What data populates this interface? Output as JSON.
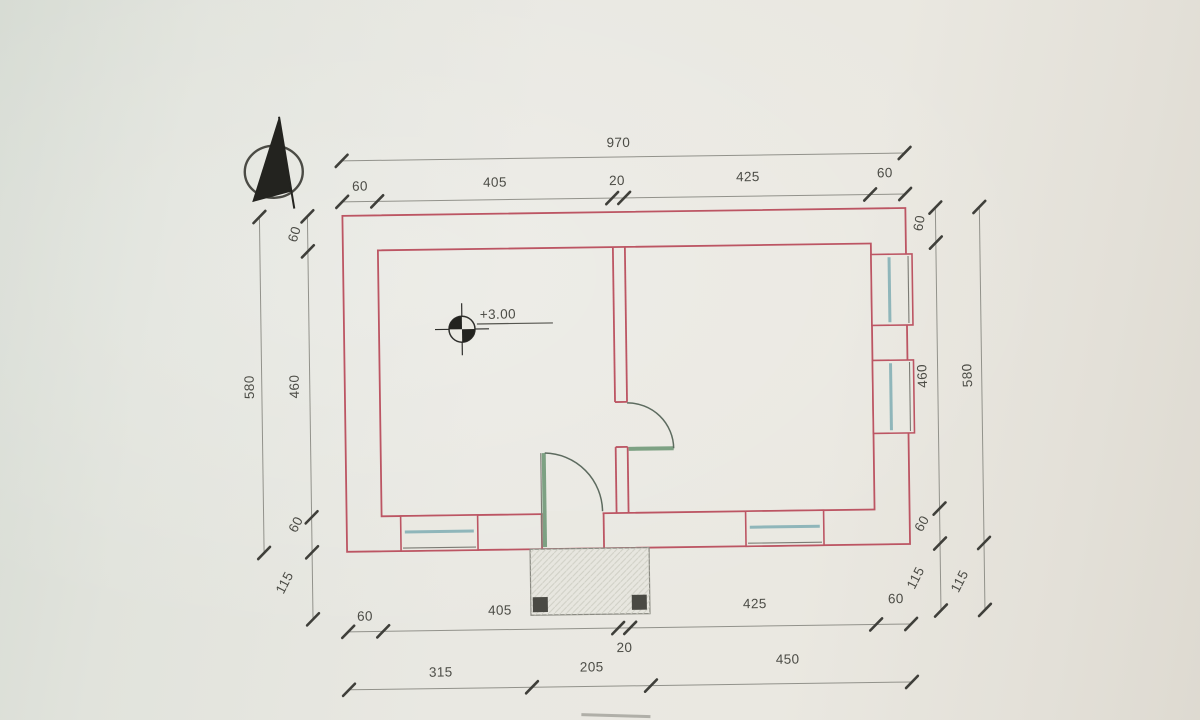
{
  "drawing": {
    "level_marker_text": "+3.00",
    "dimensions_top": {
      "overall": "970",
      "segments": [
        "60",
        "405",
        "20",
        "425",
        "60"
      ]
    },
    "dimensions_bottom": {
      "segments": [
        "60",
        "405",
        "20",
        "425",
        "60"
      ],
      "overall": [
        "315",
        "205",
        "450"
      ]
    },
    "dimensions_left": {
      "overall": "580",
      "segments": [
        "60",
        "460",
        "60",
        "115"
      ]
    },
    "dimensions_right": {
      "segments": [
        "60",
        "460",
        "60",
        "115"
      ],
      "overall": [
        "580",
        "115"
      ]
    },
    "colors": {
      "wall": "#bc5563",
      "glass": "#8fb6ba",
      "door": "#7da183",
      "paper": "#eae9e2",
      "ink": "#4c4c46"
    }
  }
}
